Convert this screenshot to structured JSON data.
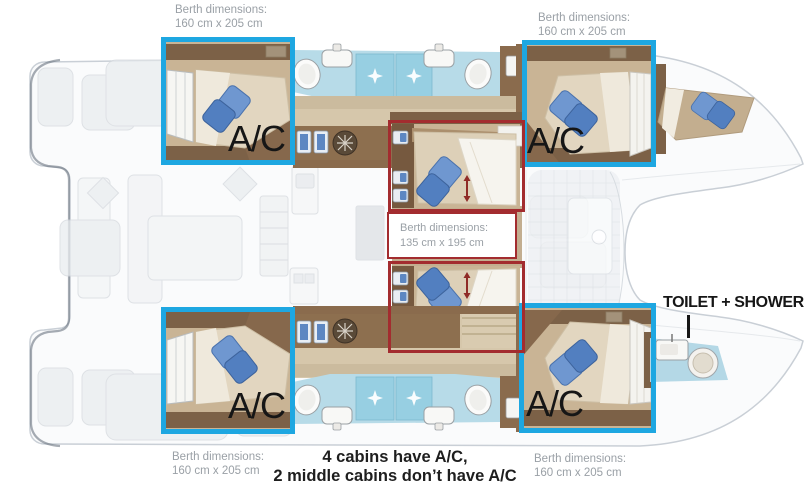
{
  "colors": {
    "highlight_blue": "#1ea7e1",
    "highlight_red": "#a32c2f",
    "label_gray": "#9aa0a6",
    "text_black": "#161616"
  },
  "berth_labels": {
    "top_left": {
      "line1": "Berth dimensions:",
      "line2": "160 cm x 205 cm"
    },
    "top_right": {
      "line1": "Berth dimensions:",
      "line2": "160 cm x 205 cm"
    },
    "bottom_left": {
      "line1": "Berth dimensions:",
      "line2": "160 cm x 205 cm"
    },
    "bottom_right": {
      "line1": "Berth dimensions:",
      "line2": "160 cm x 205 cm"
    },
    "middle": {
      "line1": "Berth dimensions:",
      "line2": "135 cm x 195 cm"
    }
  },
  "ac_labels": {
    "top_left": "A/C",
    "top_right": "A/C",
    "bottom_left": "A/C",
    "bottom_right": "A/C"
  },
  "toilet_shower": {
    "label": "TOILET + SHOWER"
  },
  "footnote": {
    "line1": "4 cabins have A/C,",
    "line2": "2 middle cabins don’t have A/C"
  }
}
